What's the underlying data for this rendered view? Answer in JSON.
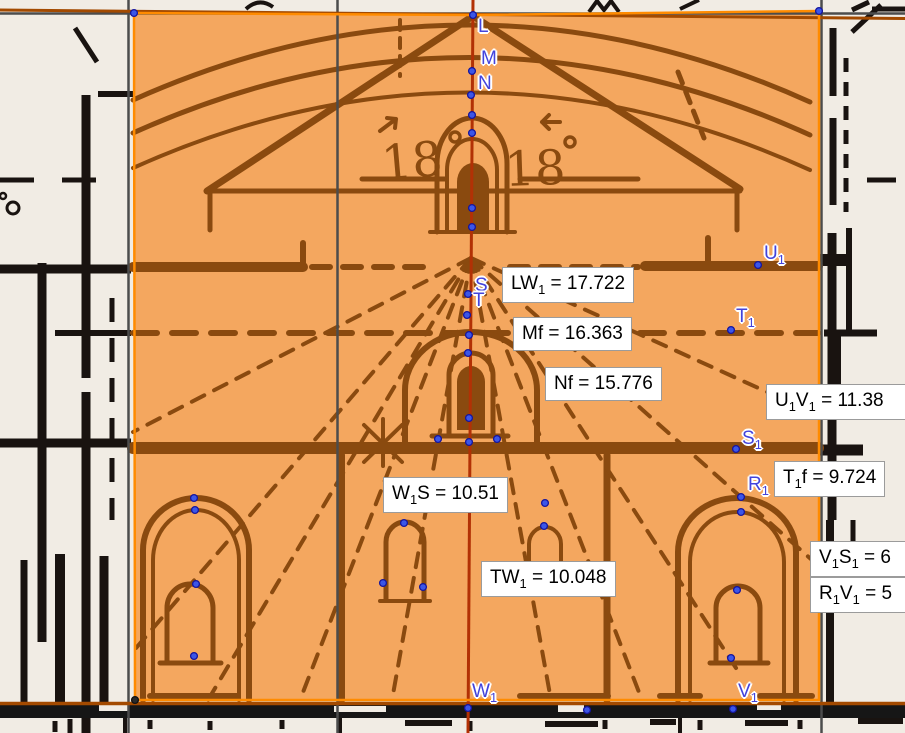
{
  "app": {
    "view": "geogebra-graphics-view",
    "width": 905,
    "height": 733
  },
  "colors": {
    "paper": "#f1ece4",
    "overlay_fill": "#f4a75f",
    "overlay_border": "#ff8b00",
    "scan_ink_outside": "#191310",
    "scan_ink_inside": "#8a4a0f",
    "axis_red": "#b23105",
    "construction_gray": "#4c4c4c",
    "rule_brown": "#a34a00",
    "point_fill": "#3b56e8",
    "point_stroke": "#15159e",
    "point_label_color": "#4343dc",
    "measure_bg": "#ffffff",
    "measure_border": "#9b9b9b"
  },
  "scan_annotations": {
    "left_numeral": "18",
    "right_numeral": "18"
  },
  "points": [
    {
      "id": "L",
      "label": "L",
      "x": 473,
      "y": 15,
      "lx": 478,
      "ly": 17
    },
    {
      "id": "M",
      "label": "M",
      "x": 472,
      "y": 71,
      "lx": 481,
      "ly": 49
    },
    {
      "id": "N",
      "label": "N",
      "x": 471,
      "y": 95,
      "lx": 478,
      "ly": 74
    },
    {
      "id": "S",
      "label": "S",
      "x": 468,
      "y": 294,
      "lx": 475,
      "ly": 276
    },
    {
      "id": "T",
      "label": "T",
      "x": 467,
      "y": 315,
      "lx": 473,
      "ly": 291
    },
    {
      "id": "U1",
      "label": "U_1",
      "x": 758,
      "y": 265,
      "lx": 764,
      "ly": 244
    },
    {
      "id": "T1",
      "label": "T_1",
      "x": 731,
      "y": 330,
      "lx": 736,
      "ly": 307
    },
    {
      "id": "S1",
      "label": "S_1",
      "x": 736,
      "y": 449,
      "lx": 742,
      "ly": 429
    },
    {
      "id": "R1",
      "label": "R_1",
      "x": 741,
      "y": 497,
      "lx": 748,
      "ly": 475
    },
    {
      "id": "W1",
      "label": "W_1",
      "x": 468,
      "y": 708,
      "lx": 472,
      "ly": 682
    },
    {
      "id": "V1",
      "label": "V_1",
      "x": 733,
      "y": 709,
      "lx": 738,
      "ly": 682
    }
  ],
  "anchors": [
    [
      134,
      13
    ],
    [
      819,
      11
    ],
    [
      472,
      115
    ],
    [
      472,
      133
    ],
    [
      472,
      208
    ],
    [
      472,
      227
    ],
    [
      469,
      335
    ],
    [
      468,
      353
    ],
    [
      469,
      418
    ],
    [
      469,
      442
    ],
    [
      438,
      439
    ],
    [
      497,
      439
    ],
    [
      404,
      523
    ],
    [
      545,
      503
    ],
    [
      544,
      526
    ],
    [
      383,
      583
    ],
    [
      423,
      587
    ],
    [
      194,
      498
    ],
    [
      195,
      510
    ],
    [
      196,
      584
    ],
    [
      194,
      656
    ],
    [
      741,
      512
    ],
    [
      737,
      590
    ],
    [
      731,
      658
    ],
    [
      587,
      710
    ]
  ],
  "dark_anchors": [
    [
      135,
      700
    ]
  ],
  "measurements": [
    {
      "id": "LW1",
      "text": "LW_1 = 17.722",
      "x": 502,
      "y": 267
    },
    {
      "id": "Mf",
      "text": "Mf = 16.363",
      "x": 513,
      "y": 317
    },
    {
      "id": "Nf",
      "text": "Nf = 15.776",
      "x": 545,
      "y": 367
    },
    {
      "id": "U1V1",
      "text": "U_1V_1 = 11.38",
      "x": 766,
      "y": 384,
      "w": 150
    },
    {
      "id": "T1f",
      "text": "T_1f = 9.724",
      "x": 774,
      "y": 461
    },
    {
      "id": "W1S",
      "text": "W_1S = 10.51",
      "x": 383,
      "y": 477
    },
    {
      "id": "TW1",
      "text": "TW_1 = 10.048",
      "x": 481,
      "y": 561
    },
    {
      "id": "V1S1",
      "text": "V_1S_1 = 6",
      "x": 810,
      "y": 541,
      "w": 120
    },
    {
      "id": "R1V1",
      "text": "R_1V_1 = 5",
      "x": 810,
      "y": 577,
      "w": 120
    }
  ]
}
